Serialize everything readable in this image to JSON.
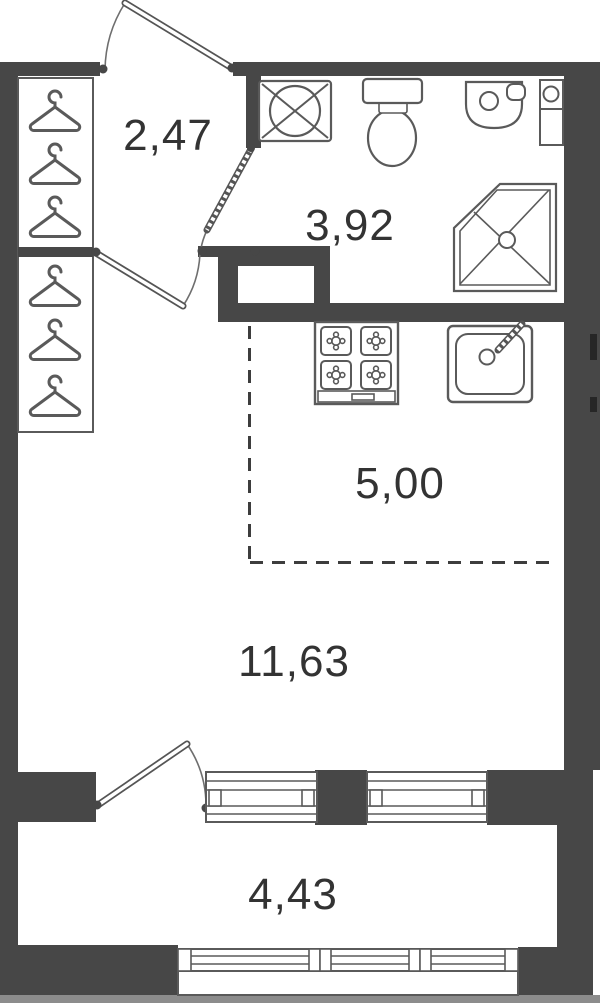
{
  "plan_type": "apartment-floor-plan",
  "colors": {
    "wall": "#474747",
    "line": "#5a5a5a",
    "label": "#333333",
    "background": "#ffffff",
    "footer_strip": "#8c8c8c"
  },
  "rooms": [
    {
      "id": "hallway",
      "area_label": "2,47"
    },
    {
      "id": "bathroom",
      "area_label": "3,92"
    },
    {
      "id": "kitchen_zone",
      "area_label": "5,00"
    },
    {
      "id": "living_room",
      "area_label": "11,63"
    },
    {
      "id": "balcony",
      "area_label": "4,43"
    }
  ],
  "fixtures": [
    {
      "name": "wardrobe-hangers-icon",
      "count": 6
    },
    {
      "name": "washing-machine-icon"
    },
    {
      "name": "toilet-icon"
    },
    {
      "name": "washbasin-icon"
    },
    {
      "name": "water-heater-icon"
    },
    {
      "name": "shower-cabin-icon"
    },
    {
      "name": "stove-4-burner-icon"
    },
    {
      "name": "kitchen-sink-icon"
    },
    {
      "name": "entrance-door-swing"
    },
    {
      "name": "bathroom-door-swing"
    },
    {
      "name": "hallway-door-swing"
    },
    {
      "name": "balcony-door-swing"
    },
    {
      "name": "balcony-window-sill"
    },
    {
      "name": "balcony-glazing"
    },
    {
      "name": "kitchen-zone-dashed-boundary"
    },
    {
      "name": "ventilation-shaft"
    }
  ]
}
